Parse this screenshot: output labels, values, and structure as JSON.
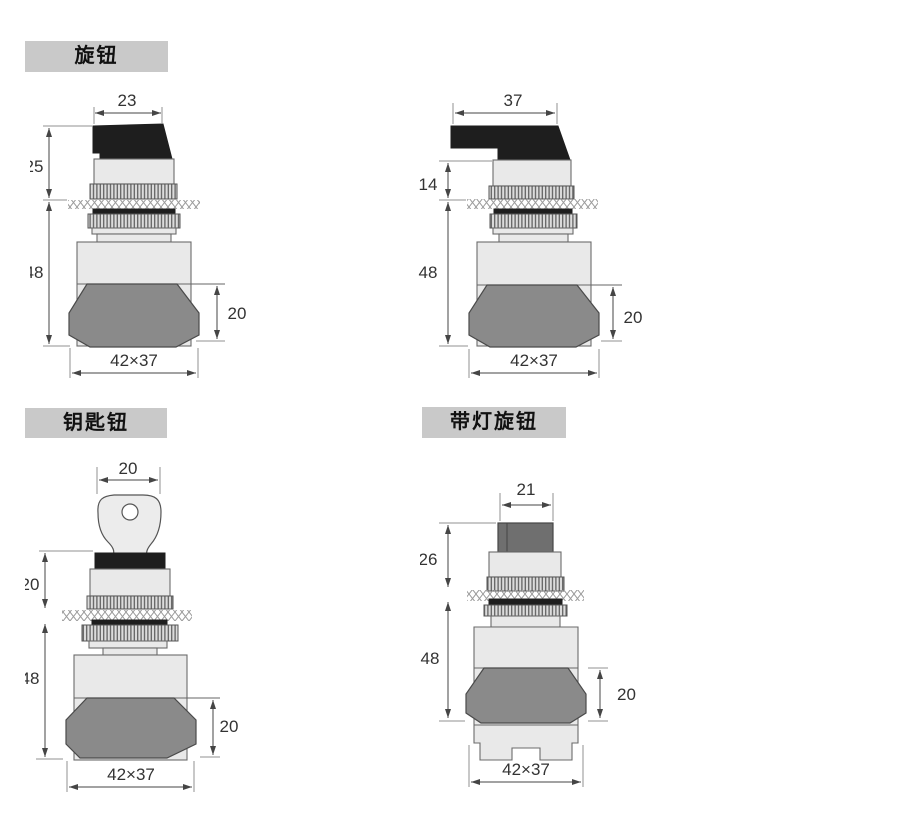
{
  "sections": {
    "knob": {
      "label": "旋钮"
    },
    "key": {
      "label": "钥匙钮"
    },
    "illuminated": {
      "label": "带灯旋钮"
    }
  },
  "drawings": {
    "knob_short": {
      "top_width": "23",
      "height_above_panel": "25",
      "height_below_panel": "48",
      "nut_height": "20",
      "base_size": "42×37"
    },
    "knob_long": {
      "top_width": "37",
      "height_above_panel": "14",
      "height_below_panel": "48",
      "nut_height": "20",
      "base_size": "42×37"
    },
    "key_switch": {
      "top_width": "20",
      "height_above_panel": "20",
      "height_below_panel": "48",
      "nut_height": "20",
      "base_size": "42×37"
    },
    "illuminated_knob": {
      "top_width": "21",
      "height_above_panel": "26",
      "height_below_panel": "48",
      "nut_height": "20",
      "base_size": "42×37"
    }
  },
  "colors": {
    "background": "#ffffff",
    "label_bg": "#c9c9c9",
    "body_fill": "#e9e9e9",
    "dark_part": "#1e1e1e",
    "nut_fill": "#8a8a8a",
    "illuminated_knob_fill": "#6f6f6f",
    "line": "#555555",
    "dim_text": "#333333"
  }
}
